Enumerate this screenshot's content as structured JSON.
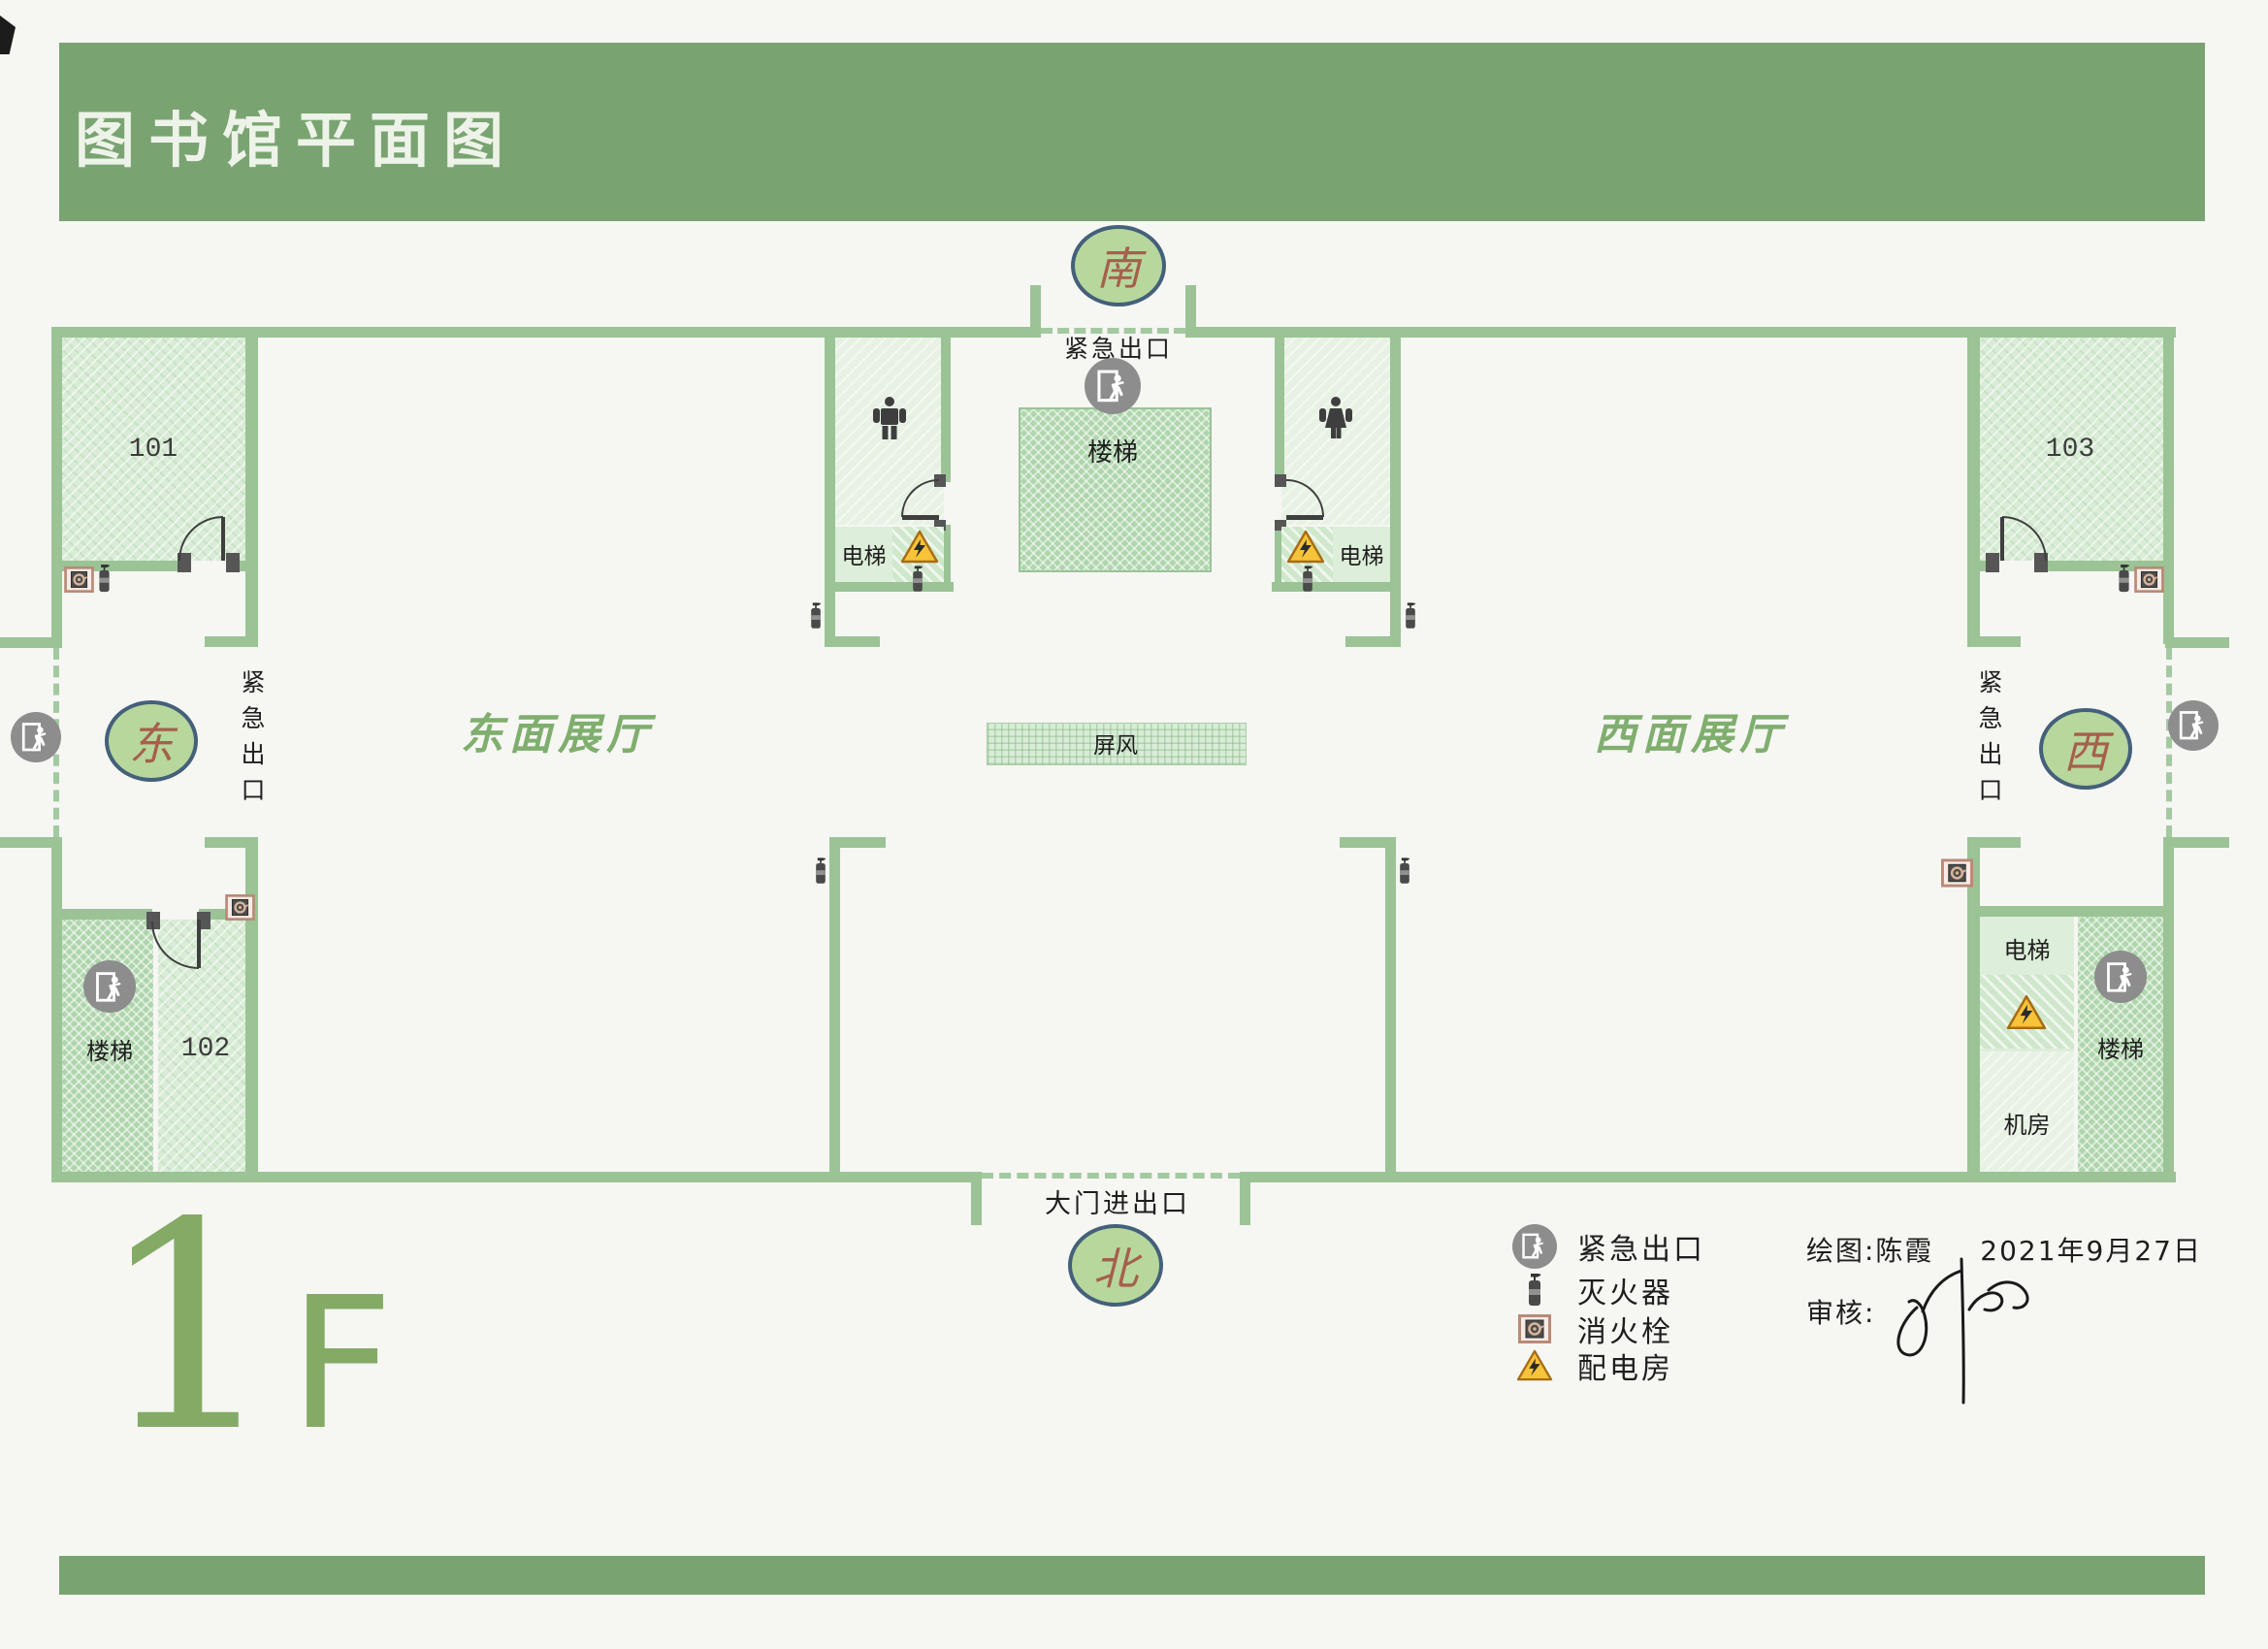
{
  "title": "图书馆平面图",
  "floor": {
    "big": "1",
    "small": "F"
  },
  "compass": {
    "south": "南",
    "north": "北",
    "east": "东",
    "west": "西"
  },
  "plan": {
    "emergency_exit_south": "紧急出口",
    "emergency_exit_east": "紧急出口",
    "emergency_exit_west": "紧急出口",
    "main_entrance": "大门进出口",
    "east_hall": "东面展厅",
    "west_hall": "西面展厅",
    "screen": "屏风",
    "stairs_center": "楼梯",
    "stairs_sw": "楼梯",
    "stairs_se": "楼梯",
    "elevator_left": "电梯",
    "elevator_right": "电梯",
    "elevator_se": "电梯",
    "machine_room": "机房",
    "rooms": {
      "r101": "101",
      "r102": "102",
      "r103": "103"
    }
  },
  "legend": {
    "items": [
      {
        "icon": "emergency-exit-icon",
        "label": "紧急出口"
      },
      {
        "icon": "fire-extinguisher-icon",
        "label": "灭火器"
      },
      {
        "icon": "fire-hydrant-icon",
        "label": "消火栓"
      },
      {
        "icon": "power-room-icon",
        "label": "配电房"
      }
    ]
  },
  "credits": {
    "drawn_by": "绘图:陈霞",
    "date": "2021年9月27日",
    "review_label": "审核:"
  },
  "colors": {
    "header_green": "#79a471",
    "wall_green": "#9bc396",
    "compass_fill": "#b7d79d",
    "compass_border": "#44607a",
    "compass_text": "#a5604c",
    "hall_label_green": "#7fae6e",
    "floor_green": "#84ab66",
    "exit_icon_gray": "#8d8d8d",
    "warning_yellow": "#f6c33a",
    "hydrant_border": "#b98a77"
  }
}
